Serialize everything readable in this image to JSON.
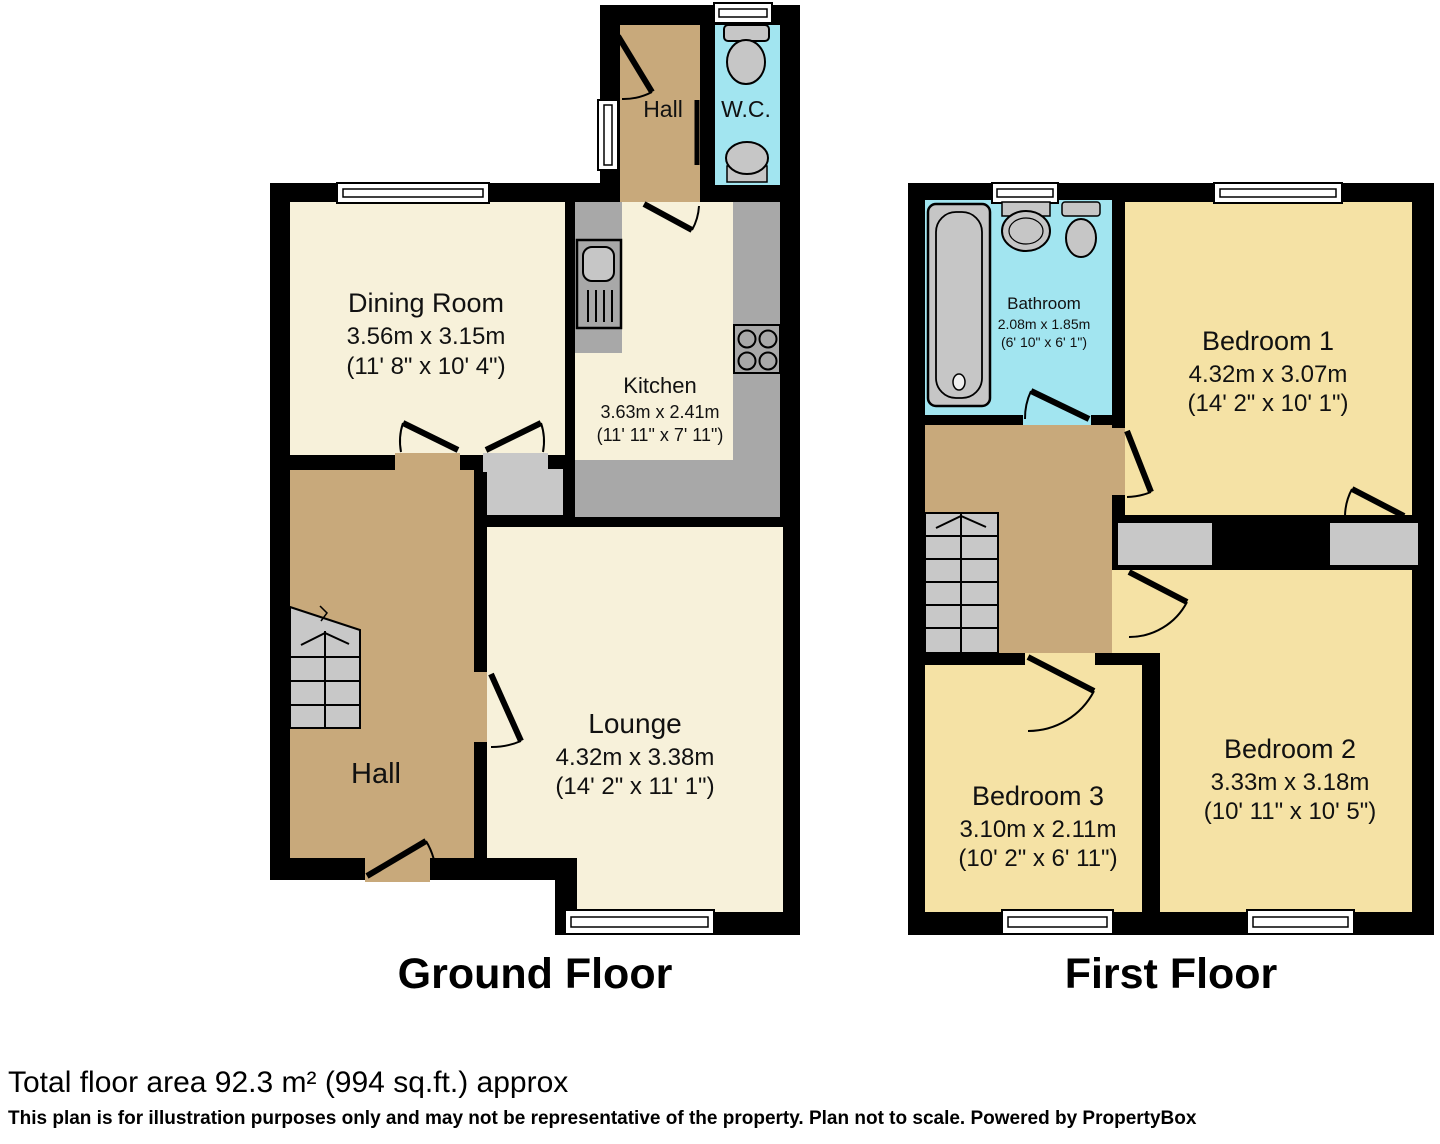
{
  "ground_floor": {
    "title": "Ground Floor",
    "dining": {
      "name": "Dining Room",
      "dims_m": "3.56m x 3.15m",
      "dims_ft": "(11' 8\" x 10' 4\")"
    },
    "kitchen": {
      "name": "Kitchen",
      "dims_m": "3.63m x 2.41m",
      "dims_ft": "(11' 11\" x 7' 11\")"
    },
    "lounge": {
      "name": "Lounge",
      "dims_m": "4.32m x 3.38m",
      "dims_ft": "(14' 2\" x 11' 1\")"
    },
    "hall": {
      "name": "Hall"
    },
    "hall_top": {
      "name": "Hall"
    },
    "wc": {
      "name": "W.C."
    }
  },
  "first_floor": {
    "title": "First Floor",
    "bathroom": {
      "name": "Bathroom",
      "dims_m": "2.08m x 1.85m",
      "dims_ft": "(6' 10\" x 6' 1\")"
    },
    "bedroom1": {
      "name": "Bedroom 1",
      "dims_m": "4.32m x 3.07m",
      "dims_ft": "(14' 2\" x 10' 1\")"
    },
    "bedroom2": {
      "name": "Bedroom 2",
      "dims_m": "3.33m x 3.18m",
      "dims_ft": "(10' 11\" x 10' 5\")"
    },
    "bedroom3": {
      "name": "Bedroom 3",
      "dims_m": "3.10m x 2.11m",
      "dims_ft": "(10' 2\" x 6' 11\")"
    }
  },
  "footer": {
    "total_area": "Total floor area 92.3 m² (994 sq.ft.) approx",
    "disclaimer": "This plan is for illustration purposes only and may not be representative of the property. Plan not to scale. Powered by PropertyBox"
  },
  "colors": {
    "wall": "#000000",
    "floor_cream": "#F7F1DA",
    "hall_tan": "#C8A97B",
    "wet_room_blue": "#A2E5F0",
    "bedroom_yellow": "#F5E2A5",
    "counter_gray": "#A8A8A8",
    "stair_gray": "#C8C8C8"
  }
}
